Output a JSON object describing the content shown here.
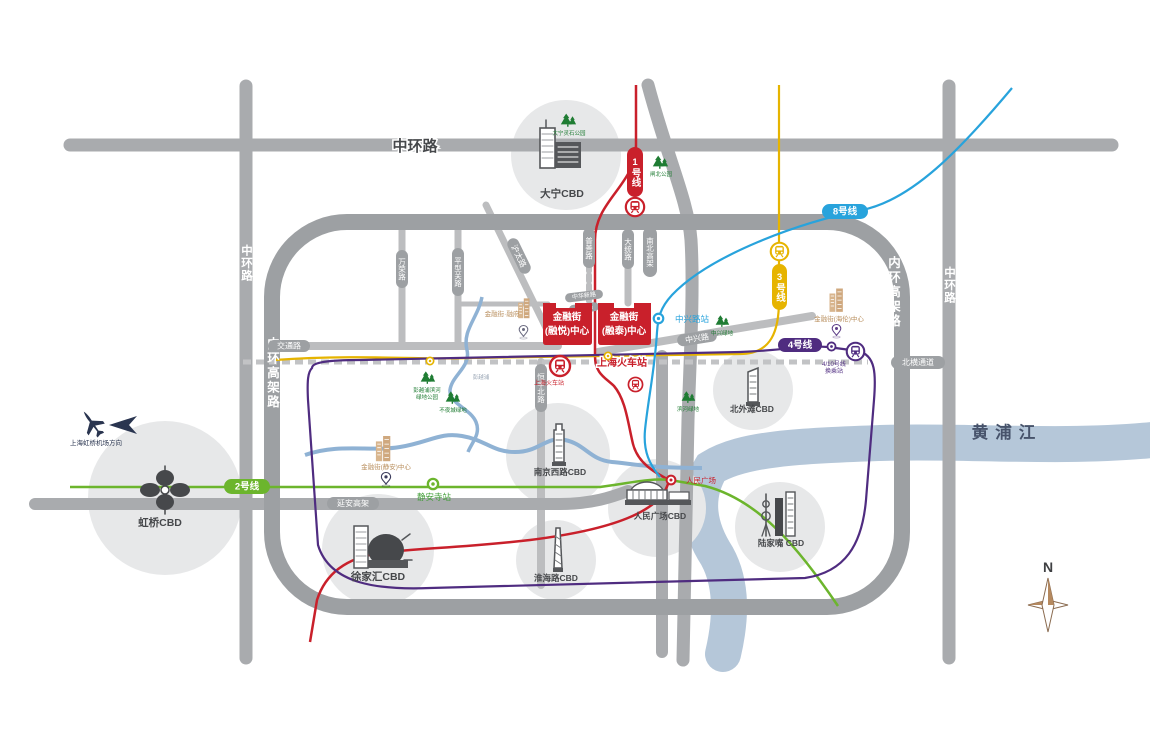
{
  "roads": {
    "mid_ring": "中环路",
    "inner_ring": "内环高架路",
    "north_south_elevated": "南北高架",
    "yanan_elevated": "延安高架",
    "beiheng_tunnel": "北横通道",
    "jiaotong_rd": "交通路",
    "zhongxing_rd": "中兴路",
    "datong_rd": "大统路",
    "hengfeng_north_rd": "恒丰北路",
    "pushan_rd": "普善路",
    "hutai_rd": "沪太路",
    "wanrong_rd": "万荣路",
    "pingxingguan_rd": "平型关路",
    "zhonghuaxin_rd": "中华新路"
  },
  "metro": {
    "line1": {
      "label": "1号线",
      "color": "#c9202b"
    },
    "line2": {
      "label": "2号线",
      "color": "#6cb52d"
    },
    "line3": {
      "label": "3号线",
      "color": "#e6b400"
    },
    "line4": {
      "label": "4号线",
      "color": "#4f2c80"
    },
    "line8": {
      "label": "8号线",
      "color": "#28a3dc"
    }
  },
  "stations": {
    "shanghai_railway_metro": "上海火车站",
    "zhongxing_rd_station": "中兴路站",
    "jingan_temple_station": "静安寺站",
    "peoples_square_station": "人民广场",
    "interchange_line1": "4/10号线",
    "interchange_line2": "换乘站"
  },
  "site": {
    "block_a_line1": "金融街",
    "block_a_line2": "(融悦)中心",
    "block_b_line1": "金融街",
    "block_b_line2": "(融泰)中心",
    "color": "#c9202b"
  },
  "projects": {
    "jingan_center": "金融街(静安)中心",
    "hailun_center": "金融街(海伦)中心",
    "rongfu": "金融街·融府"
  },
  "cbds": {
    "daning": "大宁CBD",
    "hongqiao": "虹桥CBD",
    "xujiahui": "徐家汇CBD",
    "huaihai": "淮海路CBD",
    "nanjing_west": "南京西路CBD",
    "peoples_square": "人民广场CBD",
    "north_bund": "北外滩CBD",
    "lujiazui": "陆家嘴 CBD"
  },
  "parks": {
    "daning_park": "大宁灵石公园",
    "zhabei_park": "闸北公园",
    "pengyuepu_green_line1": "彭越浦滨河",
    "pengyuepu_green_line2": "绿地公园",
    "buyecheng_green": "不夜城绿地",
    "zhongxing_green": "中兴绿地",
    "riverside_green": "滨河绿地"
  },
  "water": {
    "huangpu_river": "黄浦江",
    "pengyuepu_creek": "彭越浦"
  },
  "misc": {
    "railway_station": "上海火车站",
    "airport_direction": "上海虹桥机场方向",
    "compass_north": "N"
  }
}
